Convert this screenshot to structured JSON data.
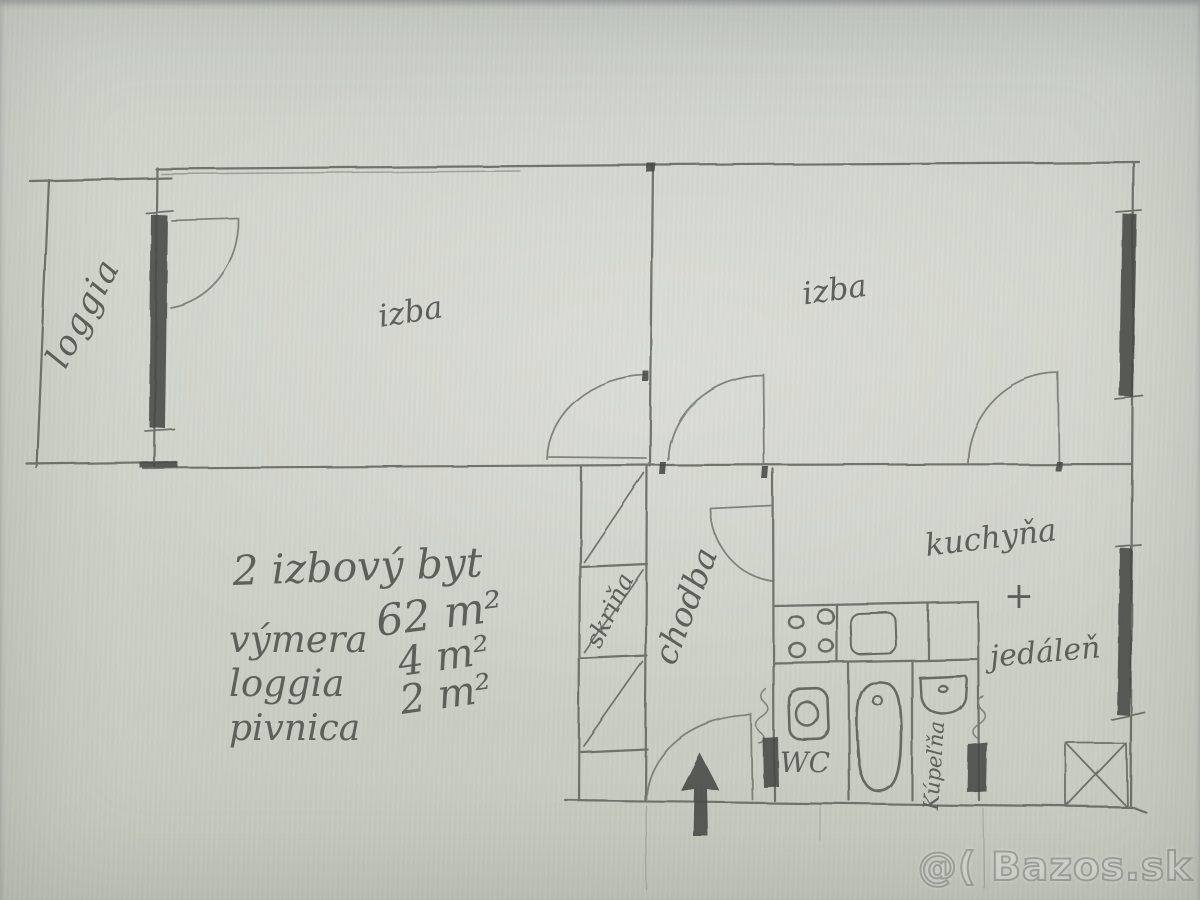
{
  "plan": {
    "room_labels": {
      "loggia": "loggia",
      "izba_left": "izba",
      "izba_right": "izba",
      "kuchyna": "kuchyňa",
      "plus": "+",
      "jedalen": "jedáleň",
      "chodba": "chodba",
      "skrina": "skriňa",
      "wc": "WC",
      "kupelna": "Kúpeľňa"
    },
    "notes": {
      "title": "2 izbový byt",
      "rows": [
        {
          "label": "výmera",
          "value": "62 m²"
        },
        {
          "label": "loggia",
          "value": "4 m²"
        },
        {
          "label": "pivnica",
          "value": "2 m²"
        }
      ]
    }
  },
  "photo": {
    "watermark": "@( Bazos.sk"
  }
}
